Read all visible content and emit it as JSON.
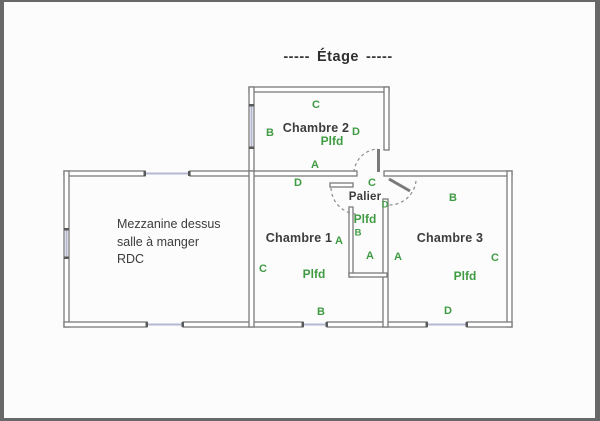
{
  "header": {
    "dash_left": "-----",
    "title": "Étage",
    "dash_right": "-----"
  },
  "colors": {
    "marker_green": "#3f9b42",
    "wall_gray": "#7a7a7a",
    "window_blue": "#b4b7d2",
    "text_dark": "#3c3c3c",
    "frame_border": "#686868"
  },
  "rooms": {
    "chambre2": {
      "name": "Chambre 2",
      "ceiling": "Plfd",
      "markers": {
        "a": "A",
        "b": "B",
        "c": "C",
        "d": "D"
      }
    },
    "chambre1": {
      "name": "Chambre 1",
      "ceiling": "Plfd",
      "markers": {
        "a": "A",
        "b": "B",
        "c": "C",
        "d": "D"
      }
    },
    "chambre3": {
      "name": "Chambre 3",
      "ceiling": "Plfd",
      "markers": {
        "a": "A",
        "b": "B",
        "c": "C",
        "d": "D"
      }
    },
    "palier": {
      "name": "Palier",
      "ceiling": "Plfd",
      "markers": {
        "a": "A",
        "b": "B",
        "c": "C",
        "d": "D"
      }
    },
    "mezzanine": {
      "line1": "Mezzanine dessus",
      "line2": "salle à manger",
      "line3": "RDC"
    }
  }
}
